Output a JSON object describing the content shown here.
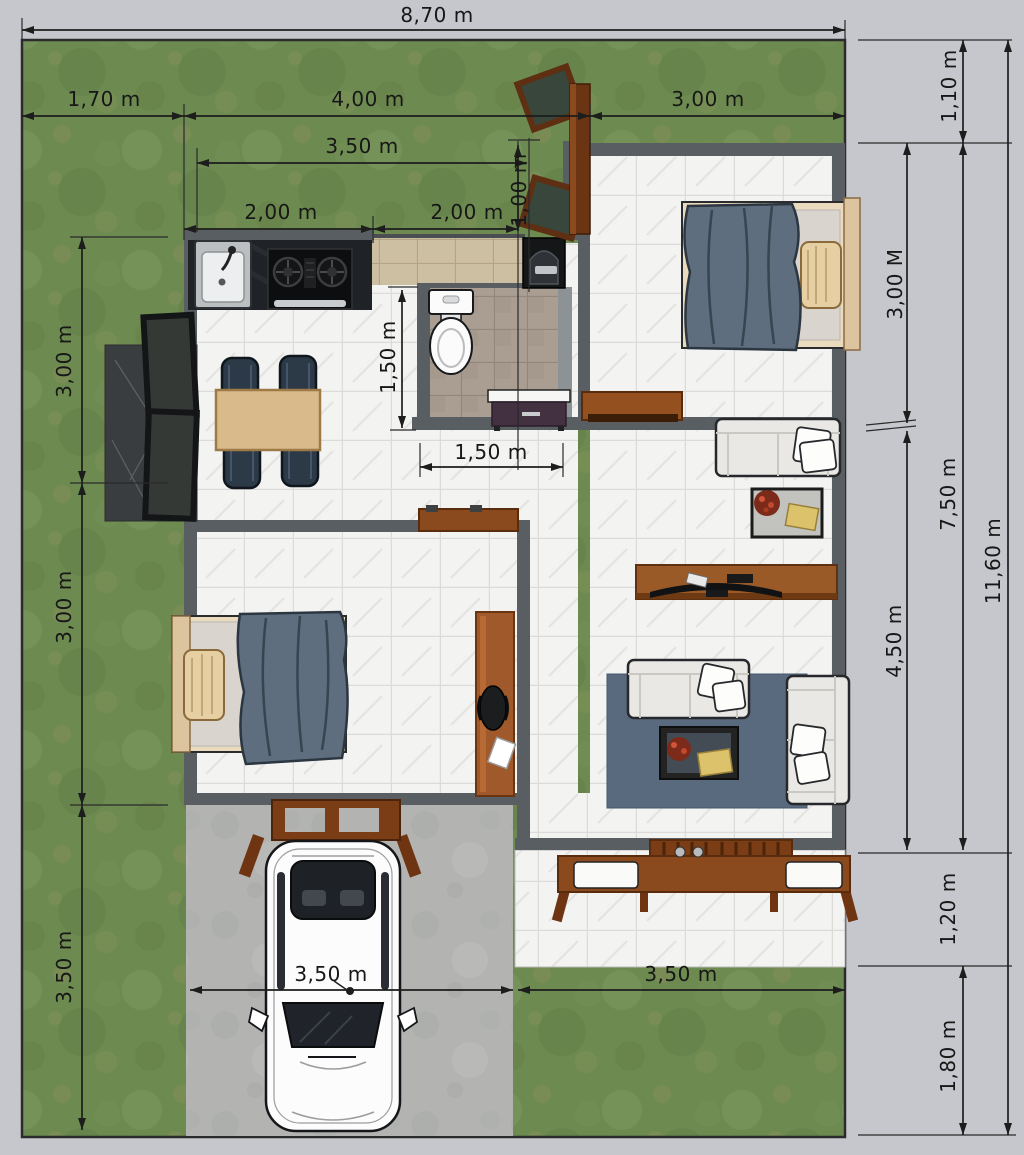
{
  "plan": {
    "type": "floor-plan-top-view",
    "description": "3D rendered small house plan on grass lot with carport, car, terrace bench, two bedrooms, bathroom, kitchen and living room"
  },
  "dims": {
    "d870": "8,70 m",
    "d170": "1,70 m",
    "d400": "4,00 m",
    "d300t": "3,00 m",
    "d350t": "3,50 m",
    "d200a": "2,00 m",
    "d200b": "2,00 m",
    "d100": "1,00 m",
    "d150v": "1,50 m",
    "d150h": "1,50 m",
    "d350car": "3,50 m",
    "d350r": "3,50 m",
    "d110": "1,10 m",
    "d300M": "3,00 M",
    "d750": "7,50 m",
    "d1160": "11,60 m",
    "d450": "4,50 m",
    "d120": "1,20 m",
    "d180": "1,80 m",
    "d300a": "3,00 m",
    "d300b": "3,00 m",
    "d350l": "3,50 m"
  },
  "colors": {
    "page_bg": "#c6c6cd",
    "grass": "#6d8b50",
    "concrete": "#b3b4b2",
    "wall": "#595e62",
    "tile": "#f3f3f2",
    "bathroom_tile": "#aa9d91",
    "porch_tile": "#cdbfa2",
    "wood": "#8a4a1e",
    "rug": "#59697e",
    "blanket": "#5e6e7e",
    "sofa": "#e9e8e4",
    "dimension_text": "#171717"
  }
}
